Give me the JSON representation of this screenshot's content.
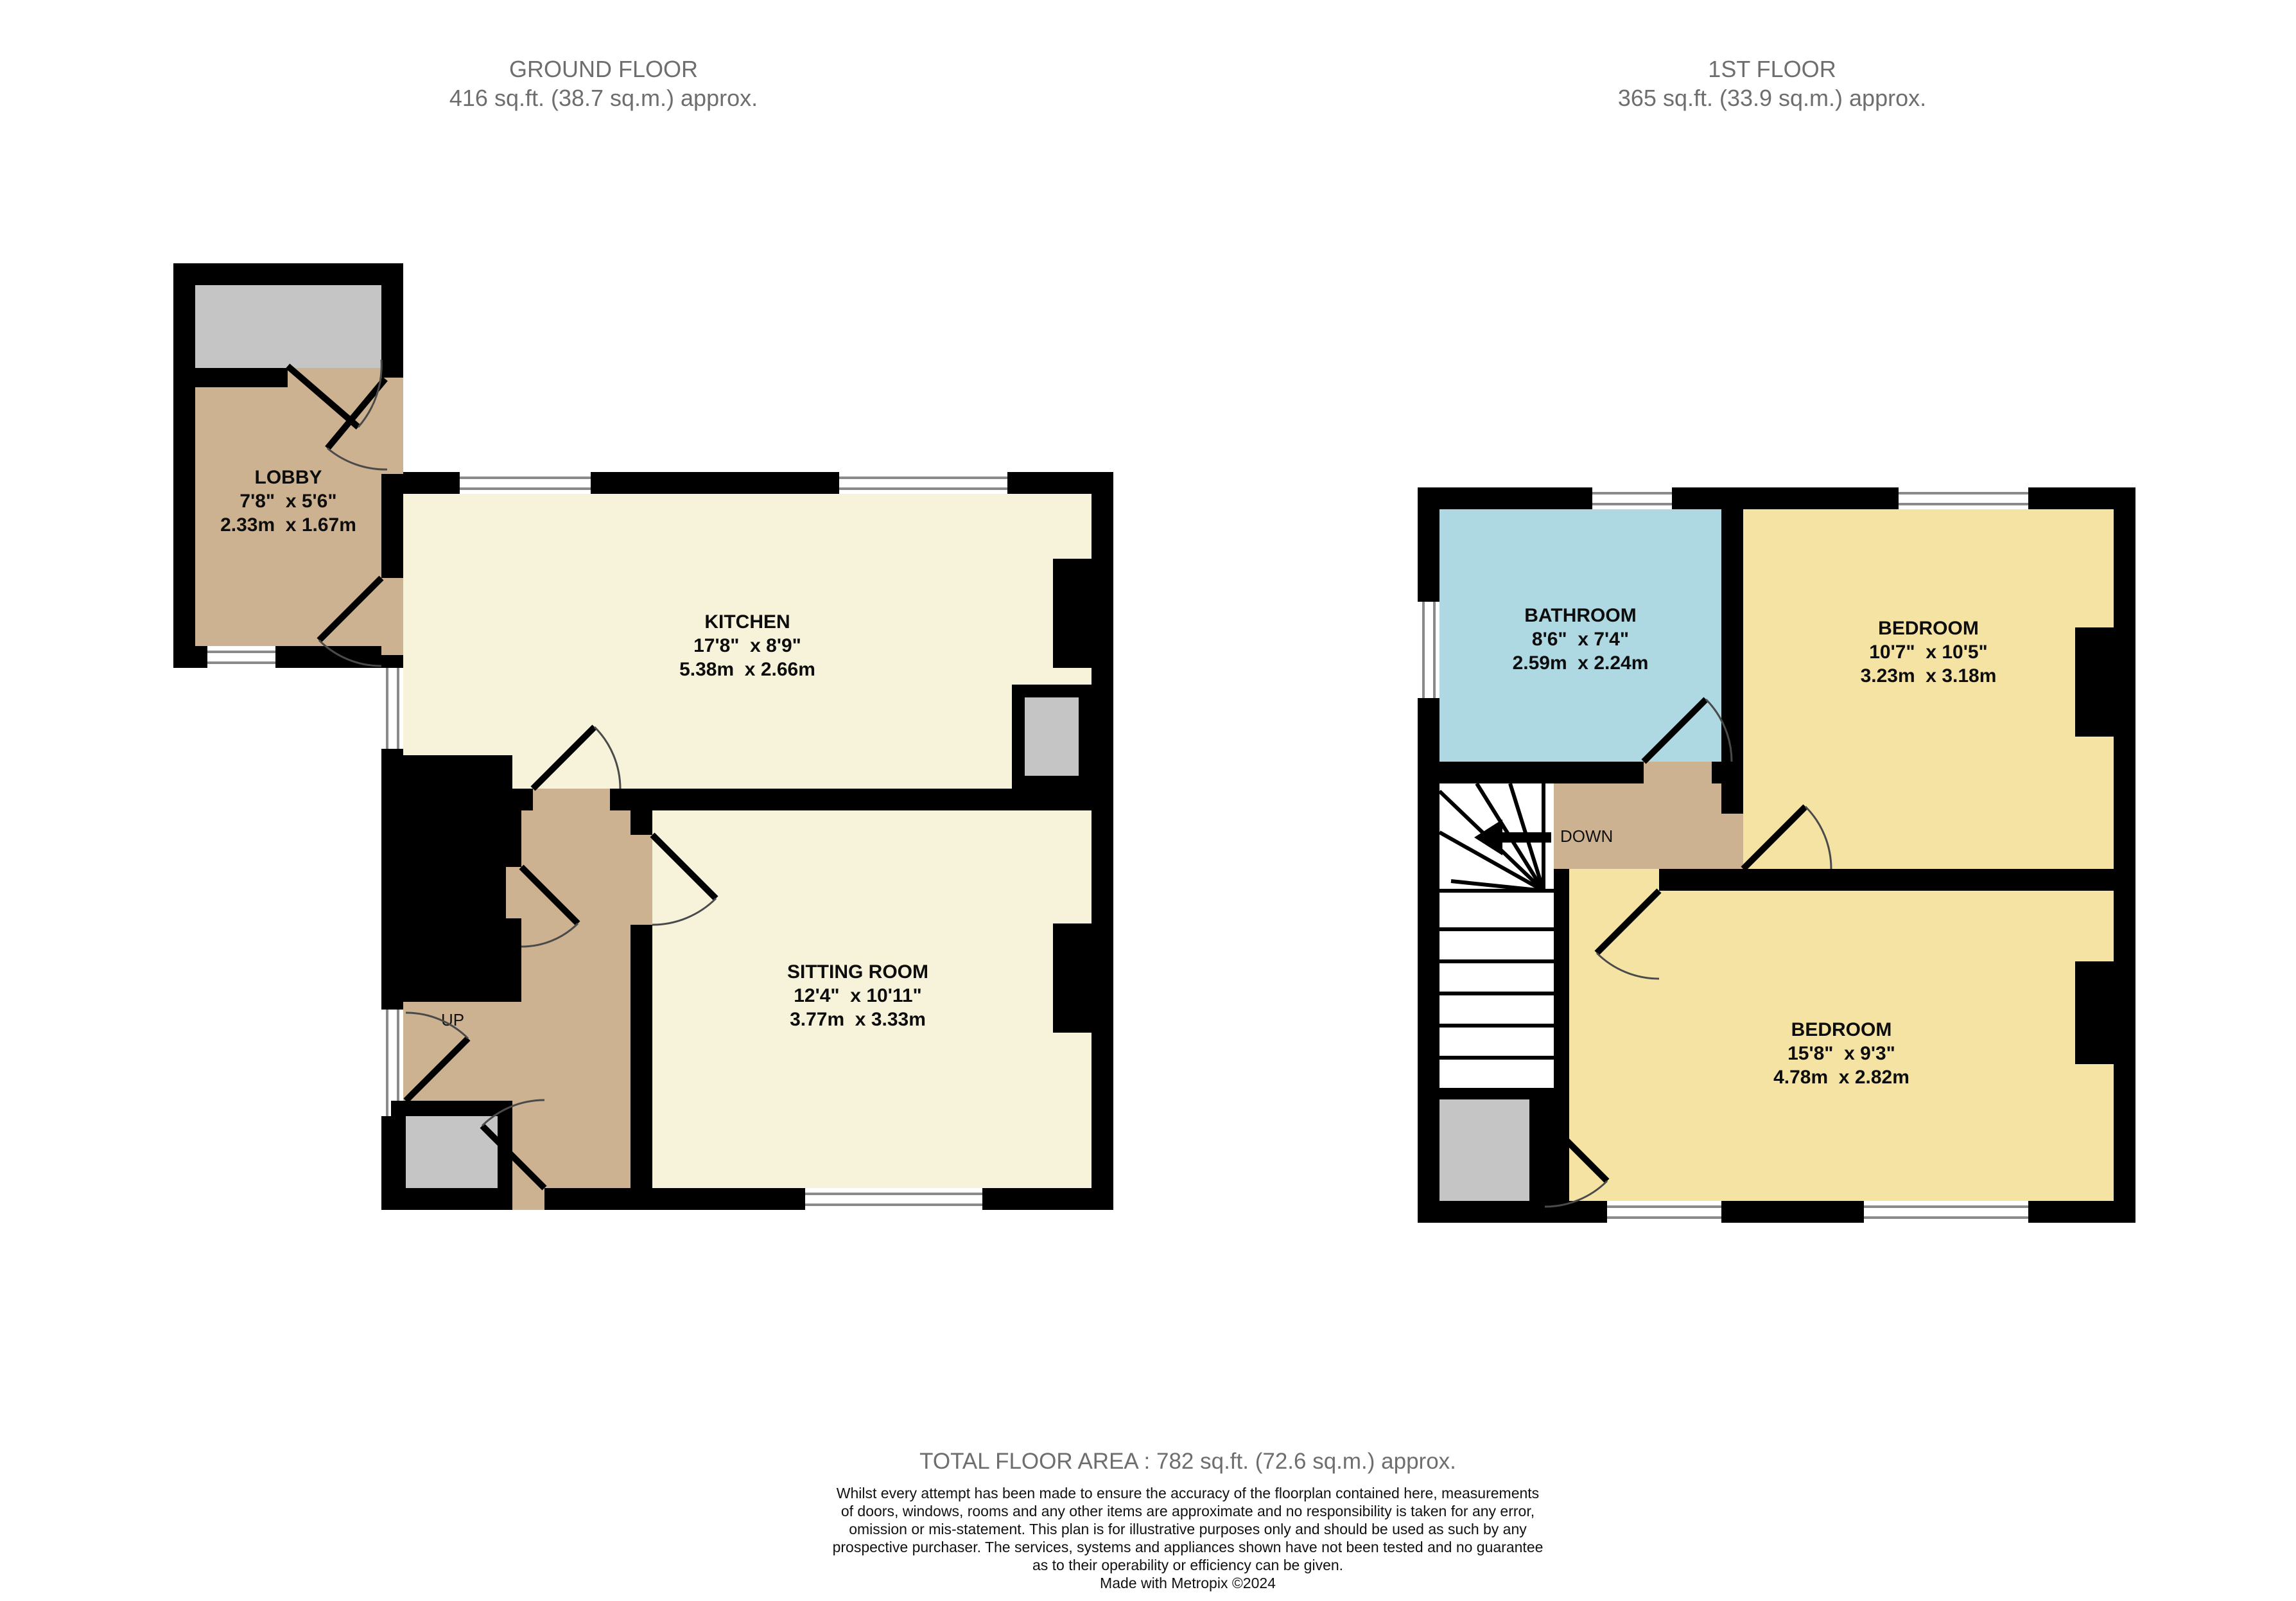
{
  "colors": {
    "wall": "#000000",
    "kitchen_floor": "#F7F2DA",
    "hall_floor": "#CDB291",
    "bedroom_floor": "#F5E3A4",
    "bathroom_floor": "#AED8E2",
    "external_gray": "#C5C5C5",
    "title_text": "#6E6E6E",
    "window_line": "#8A8A8A"
  },
  "floors": [
    {
      "id": "ground",
      "title": "GROUND FLOOR",
      "area": "416 sq.ft. (38.7 sq.m.) approx.",
      "stairs_label": "UP",
      "rooms": [
        {
          "name": "LOBBY",
          "imperial": "7'8\"  x 5'6\"",
          "metric": "2.33m  x 1.67m"
        },
        {
          "name": "KITCHEN",
          "imperial": "17'8\"  x 8'9\"",
          "metric": "5.38m  x 2.66m"
        },
        {
          "name": "SITTING ROOM",
          "imperial": "12'4\"  x 10'11\"",
          "metric": "3.77m  x 3.33m"
        }
      ]
    },
    {
      "id": "first",
      "title": "1ST FLOOR",
      "area": "365 sq.ft. (33.9 sq.m.) approx.",
      "stairs_label": "DOWN",
      "rooms": [
        {
          "name": "BATHROOM",
          "imperial": "8'6\"  x 7'4\"",
          "metric": "2.59m  x 2.24m"
        },
        {
          "name": "BEDROOM",
          "imperial": "10'7\"  x 10'5\"",
          "metric": "3.23m  x 3.18m"
        },
        {
          "name": "BEDROOM",
          "imperial": "15'8\"  x 9'3\"",
          "metric": "4.78m  x 2.82m"
        }
      ]
    }
  ],
  "footer": {
    "total": "TOTAL FLOOR AREA : 782 sq.ft. (72.6 sq.m.) approx.",
    "disclaimer": "Whilst every attempt has been made to ensure the accuracy of the floorplan contained here, measurements\nof doors, windows, rooms and any other items are approximate and no responsibility is taken for any error,\nomission or mis-statement. This plan is for illustrative purposes only and should be used as such by any\nprospective purchaser. The services, systems and appliances shown have not been tested and no guarantee\nas to their operability or efficiency can be given.",
    "credit": "Made with Metropix ©2024"
  }
}
